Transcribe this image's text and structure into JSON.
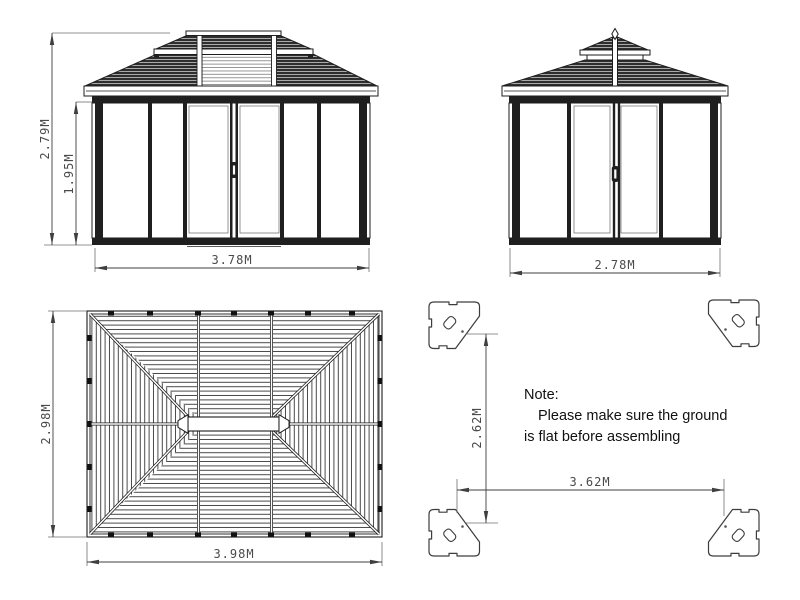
{
  "title": "Gazebo assembly dimension drawing",
  "colors": {
    "background": "#ffffff",
    "line": "#1c1c1c",
    "roof_fill": "#2e2e2e",
    "roof_slat_light": "#b8b8b8",
    "dim_line": "#3f3f3f",
    "dim_text": "#4a4a4a",
    "note_text": "#111111"
  },
  "views": {
    "front": {
      "name": "front-elevation",
      "dims": {
        "total_height": "2.79M",
        "wall_height": "1.95M",
        "width": "3.78M"
      }
    },
    "side": {
      "name": "side-elevation",
      "dims": {
        "width": "2.78M"
      }
    },
    "roof_plan": {
      "name": "roof-plan",
      "dims": {
        "depth": "2.98M",
        "width": "3.98M"
      }
    },
    "footprint": {
      "name": "base-footprint",
      "plate_count": 4,
      "dims": {
        "depth": "2.62M",
        "width": "3.62M"
      }
    }
  },
  "note": {
    "title": "Note:",
    "line1": "Please make sure the ground",
    "line2": "is flat before assembling"
  }
}
